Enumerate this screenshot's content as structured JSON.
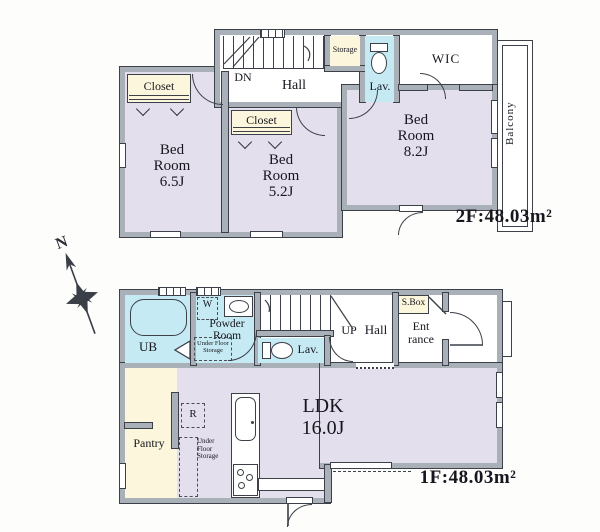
{
  "plan": {
    "compass_label": "N",
    "floor2": {
      "area_label": "2F:48.03m²",
      "labels": {
        "closet1": "Closet",
        "closet2": "Closet",
        "dn": "DN",
        "hall": "Hall",
        "storage": "Storage",
        "lav": "Lav.",
        "wic": "WIC",
        "bedroom_65": "Bed\nRoom\n6.5J",
        "bedroom_52": "Bed\nRoom\n5.2J",
        "bedroom_82": "Bed\nRoom\n8.2J",
        "balcony": "Balcony"
      }
    },
    "floor1": {
      "area_label": "1F:48.03m²",
      "labels": {
        "ub": "UB",
        "washer": "W",
        "powder": "Powder\nRoom",
        "ufs_powder": "Under Floor\nStorage",
        "lav": "Lav.",
        "up": "UP",
        "hall": "Hall",
        "sbox": "S.Box",
        "entrance": "Ent\nrance",
        "pantry": "Pantry",
        "fridge": "R",
        "ufs_kitchen": "Under\nFloor\nStorage",
        "ldk": "LDK\n16.0J"
      }
    },
    "colors": {
      "wall": "#aab0b8",
      "outline": "#3c4048",
      "room_lavender": "#e4dfec",
      "service_cream": "#fcf6dc",
      "wet_blue": "#c6eaf3",
      "paper": "#ffffff",
      "text": "#16161e"
    }
  }
}
